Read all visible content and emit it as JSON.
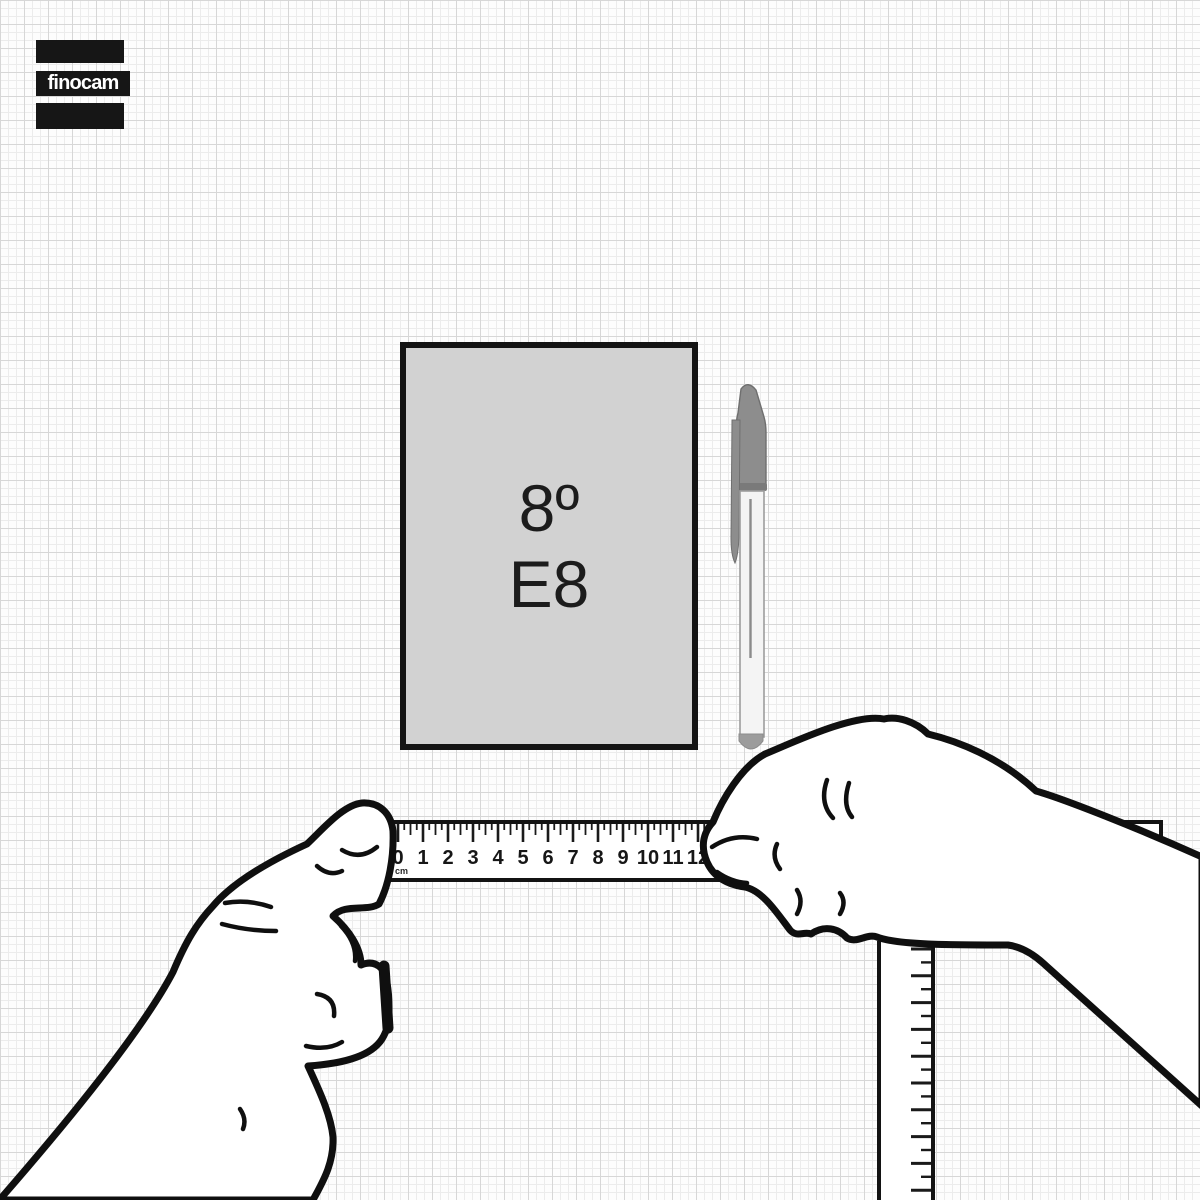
{
  "brand": {
    "logo_text": "finocam"
  },
  "notebook": {
    "size_label": "8º",
    "code_label": "E8"
  },
  "ruler": {
    "unit": "cm",
    "numbers": [
      "0",
      "1",
      "2",
      "3",
      "4",
      "5",
      "6",
      "7",
      "8",
      "9",
      "10",
      "11",
      "12"
    ],
    "cm_spacing_px": 25
  },
  "colors": {
    "background": "#fdfdfd",
    "grid_minor": "#ececec",
    "grid_major": "#d7d7d7",
    "ink": "#131313",
    "notebook_fill": "#d2d2d2",
    "logo_bg": "#161616",
    "logo_text": "#ffffff",
    "pen_gray": "#8d8d8d"
  }
}
